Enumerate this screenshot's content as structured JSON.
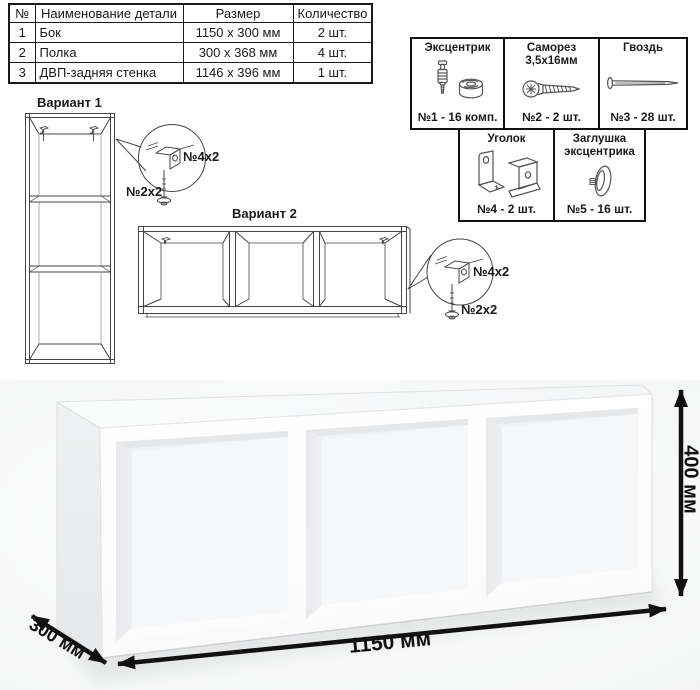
{
  "parts_table": {
    "headers": [
      "№",
      "Наименование детали",
      "Размер",
      "Количество"
    ],
    "rows": [
      {
        "num": "1",
        "name": "Бок",
        "size": "1150 x 300 мм",
        "qty": "2 шт."
      },
      {
        "num": "2",
        "name": "Полка",
        "size": "300 x 368 мм",
        "qty": "4 шт."
      },
      {
        "num": "3",
        "name": "ДВП-задняя стенка",
        "size": "1146 x 396 мм",
        "qty": "1 шт."
      }
    ]
  },
  "hardware": {
    "items": [
      {
        "label": "Эксцентрик",
        "label2": "",
        "count": "№1 - 16 комп.",
        "icon": "eccentric-bolt-and-cam-icon"
      },
      {
        "label": "Саморез",
        "label2": "3,5х16мм",
        "count": "№2 - 2 шт.",
        "icon": "screw-icon"
      },
      {
        "label": "Гвоздь",
        "label2": "",
        "count": "№3 - 28 шт.",
        "icon": "nail-icon"
      },
      {
        "label": "Уголок",
        "label2": "",
        "count": "№4 - 2 шт.",
        "icon": "corner-bracket-icon"
      },
      {
        "label": "Заглушка",
        "label2": "эксцентрика",
        "count": "№5 - 16 шт.",
        "icon": "cam-cap-icon"
      }
    ]
  },
  "variant1": {
    "title": "Вариант 1",
    "bracket_label": "№4х2",
    "screw_label": "№2х2"
  },
  "variant2": {
    "title": "Вариант 2",
    "bracket_label": "№4х2",
    "screw_label": "№2х2"
  },
  "dimensions": {
    "width": "1150 мм",
    "depth": "300 мм",
    "height": "400 мм"
  },
  "colors": {
    "ink": "#1a1a1a",
    "line_art": "#4a4a4a",
    "shelf_shading": "#e9ebec",
    "arrow": "#111111"
  }
}
